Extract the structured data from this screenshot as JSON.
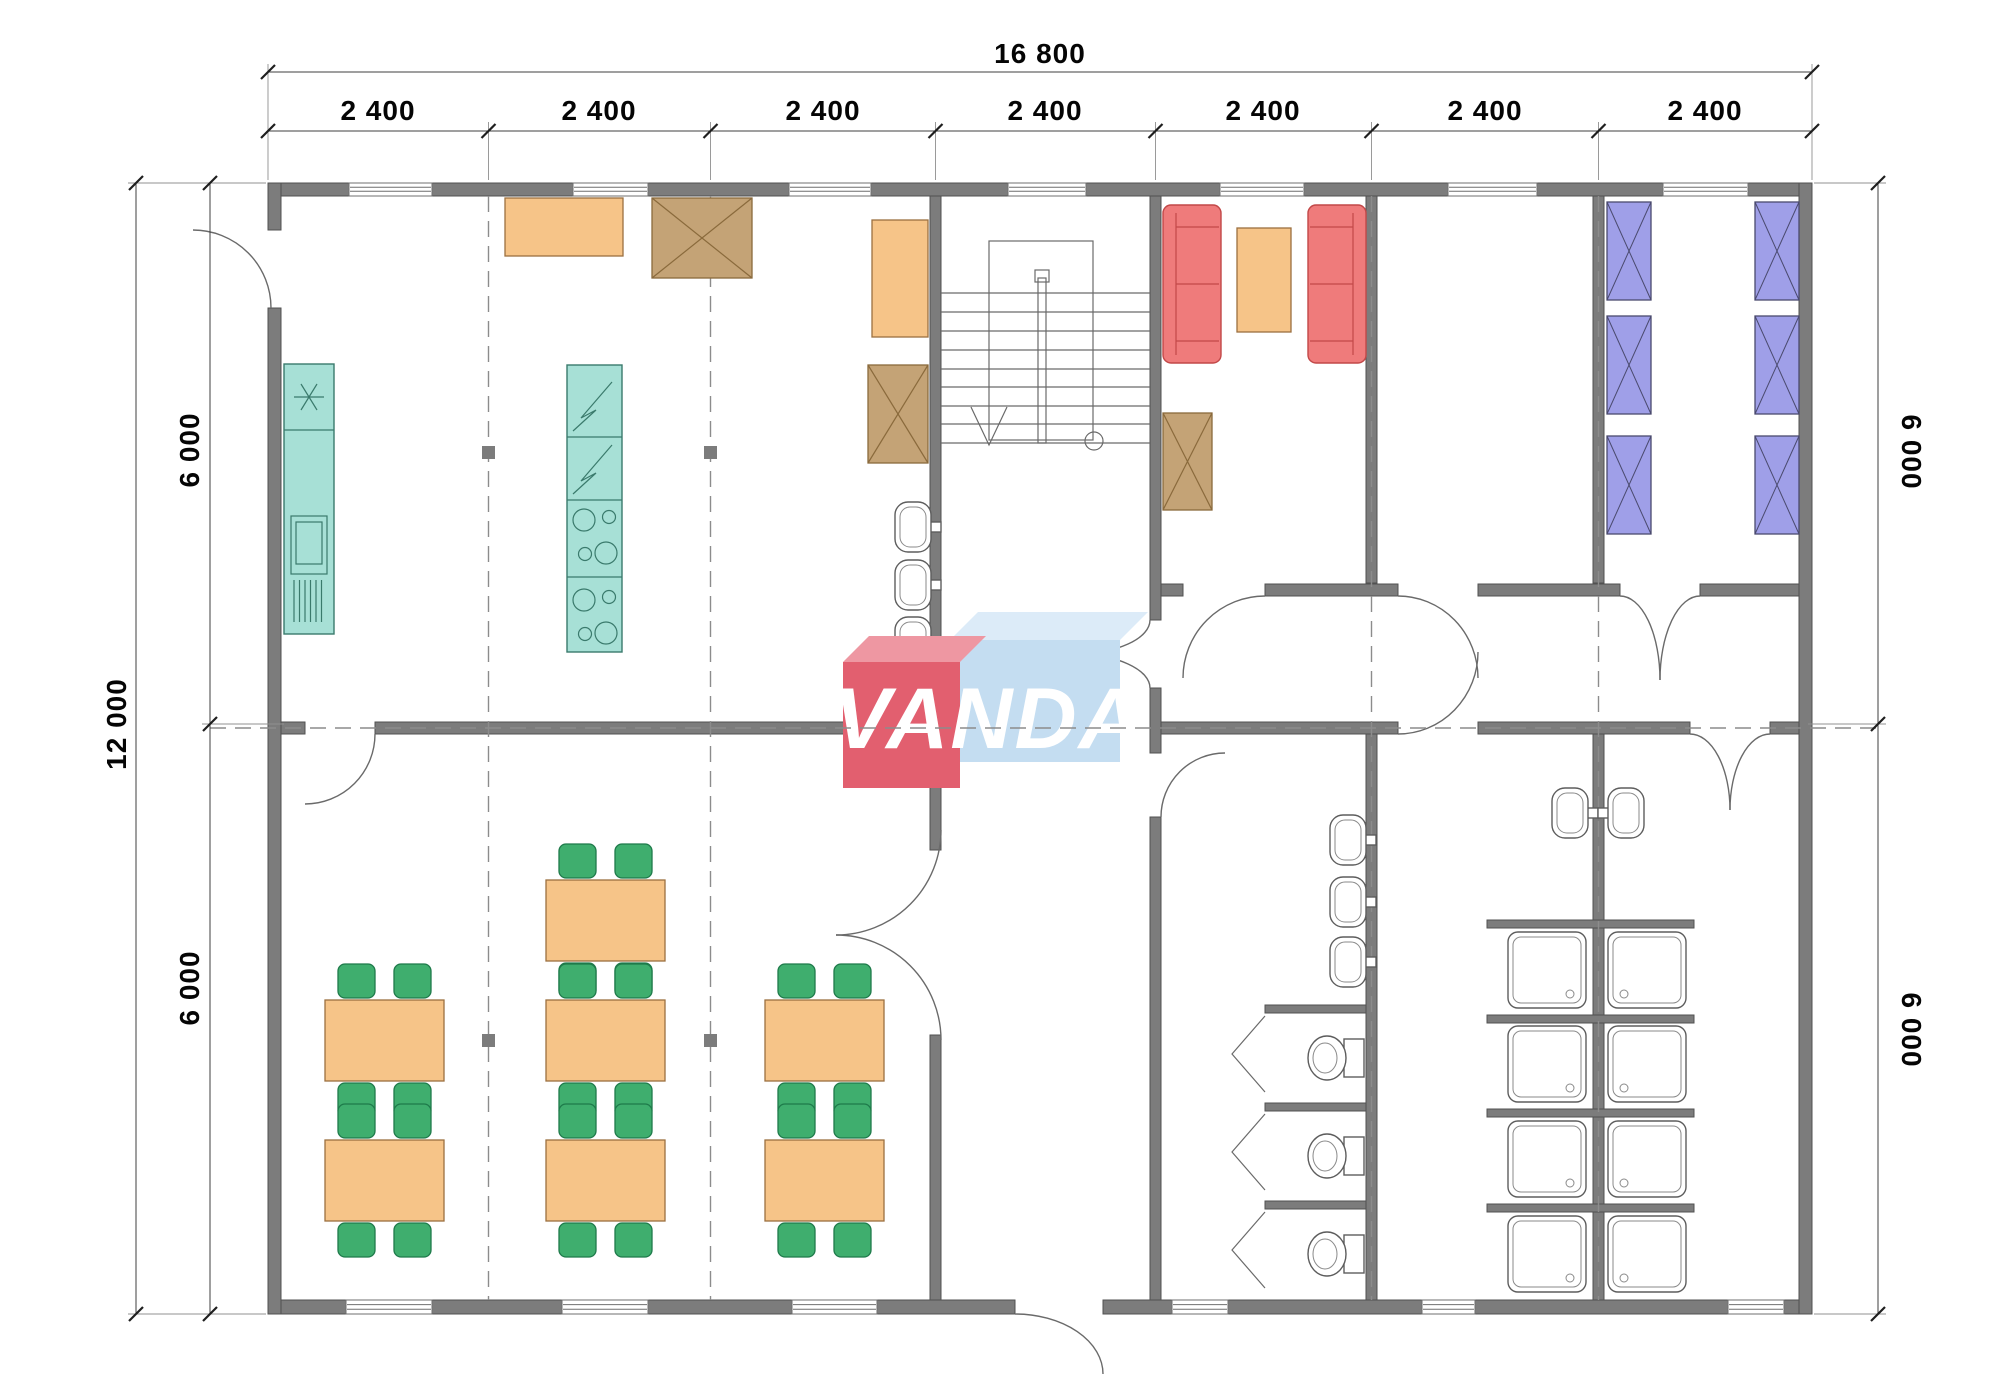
{
  "logo": {
    "text": "VANDA",
    "colors": {
      "logo_red": "#e25f6f",
      "logo_red_top": "#ee97a2",
      "logo_blue": "#c4ddf1",
      "logo_blue_top": "#dcebf8"
    }
  },
  "dimensions": {
    "top_total": "16 800",
    "top_segments": [
      "2 400",
      "2 400",
      "2 400",
      "2 400",
      "2 400",
      "2 400",
      "2 400"
    ],
    "left_total": "12 000",
    "left_segments": [
      "6 000",
      "6 000"
    ],
    "right_segments": [
      "6 000",
      "6 000"
    ]
  },
  "palette": {
    "wall": "#7c7c7c",
    "wall_edge": "#515151",
    "teal": "#a7e0d6",
    "teal_edge": "#3a7a6c",
    "orange": "#f6c488",
    "orange_edge": "#9c7040",
    "brown": "#c4a376",
    "brown_edge": "#8a6a3c",
    "sofa": "#ef7b7b",
    "sofa_edge": "#c24848",
    "chair": "#3fae6e",
    "chair_edge": "#1e7a4a",
    "bed": "#9f9fe8",
    "bed_edge": "#4a4a6e",
    "dash": "#8c8c8c",
    "logo_red": "#e25f6f",
    "logo_red_top": "#ee97a2",
    "logo_blue": "#c4ddf1",
    "logo_blue_top": "#dcebf8"
  },
  "symbols": {
    "bed-icon": "rectangle with X cross",
    "wardrobe-icon": "rectangle with X cross",
    "shower-icon": "rounded square tray with drain",
    "toilet-icon": "bowl ellipse with cistern",
    "sink-icon": "oval basin with tap",
    "stairs-icon": "treads with centre rail, down arrow and start circle",
    "cooker-icon": "panels with burner circles and zigzag marks",
    "fridge-icon": "snowflake asterisk",
    "dining-set-icon": "table with four chairs",
    "sofa-icon": "rounded rectangle with cushions"
  },
  "depicted_contents": {
    "kitchen": {
      "counter_units": 2,
      "fridge": 1,
      "cooker": 1,
      "wash_basins": 3,
      "wardrobes": 2,
      "tables": 2
    },
    "dining_room": {
      "tables": 7,
      "chairs_per_table": 4
    },
    "lounge": {
      "sofas": 2,
      "coffee_tables": 1,
      "wardrobes": 1
    },
    "bedroom": {
      "beds": 6
    },
    "washroom": {
      "wash_basins": 3,
      "toilet_stalls": 3
    },
    "shower_room": {
      "shower_trays": 8,
      "wash_basins": 2
    },
    "stairwell": {
      "stairs": 1
    }
  }
}
